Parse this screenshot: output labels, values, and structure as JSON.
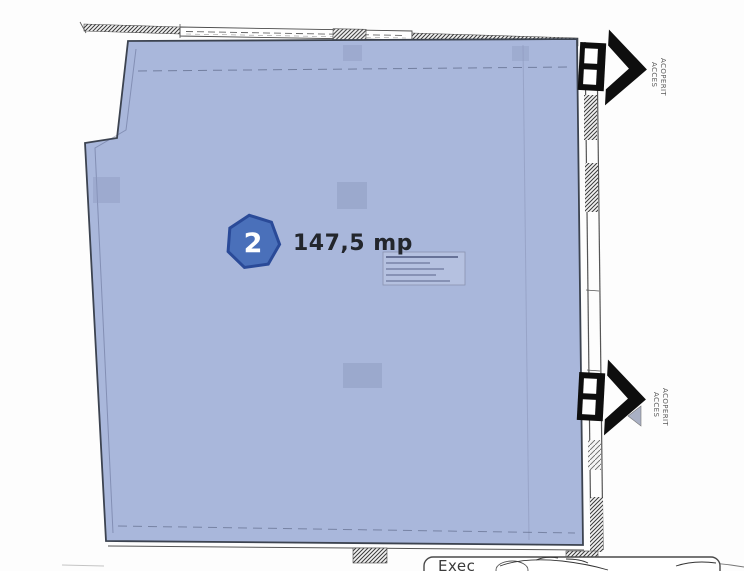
{
  "room": {
    "badge": "2",
    "area_label": "147,5 mp"
  },
  "access": [
    {
      "line1": "ACCES",
      "line2": "ACOPERIT"
    },
    {
      "line1": "ACCES",
      "line2": "ACOPERIT"
    }
  ],
  "stamp": {
    "text": "Exec"
  },
  "colors": {
    "room_fill": "#a9b7db",
    "room_border": "#3c4350",
    "badge_fill": "#4a70ba",
    "badge_border": "#2a4a98",
    "arrow_black": "#0e0e0e",
    "label_text": "#23262c"
  }
}
